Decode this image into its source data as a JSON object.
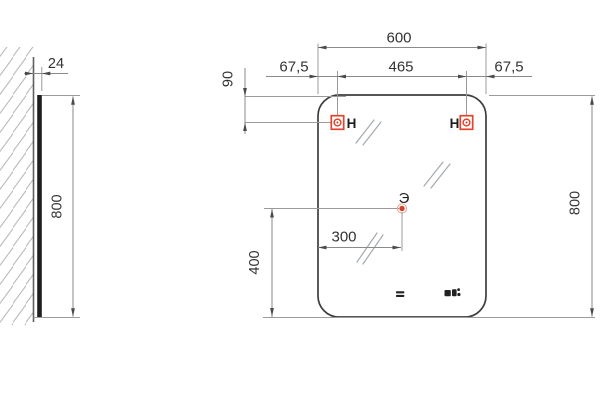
{
  "drawing": {
    "description": "Technical dimension drawing of wall-mounted mirror, side view and front view",
    "units_style": "millimeters, comma decimal separator",
    "labels": {
      "side_depth": "24",
      "side_height": "800",
      "front_width": "600",
      "front_left_offset": "67,5",
      "front_hole_spacing": "465",
      "front_right_offset": "67,5",
      "hole_top_offset": "90",
      "front_height": "800",
      "point_offset_x": "300",
      "point_offset_y": "400",
      "point_name": "Э",
      "hole_left": "H",
      "hole_right": "H"
    },
    "icons": {
      "left_hole_marker": "mount-point-square-circle",
      "right_hole_marker": "mount-point-square-circle",
      "touch_switch": "two-bar-touch-switch",
      "clock_display": "digital-clock-display",
      "wall_hatch": "diagonal-hatch",
      "mirror_reflection": "double-slash-glare"
    },
    "colors": {
      "accent_red": "#e2452c",
      "point_red": "#d7402b",
      "line_dark": "#3e3e3e",
      "dim_line": "#8a8a8a",
      "ext_line": "#9b9b9b",
      "hatch": "#b6babd",
      "text": "#333333",
      "background": "#ffffff"
    }
  }
}
